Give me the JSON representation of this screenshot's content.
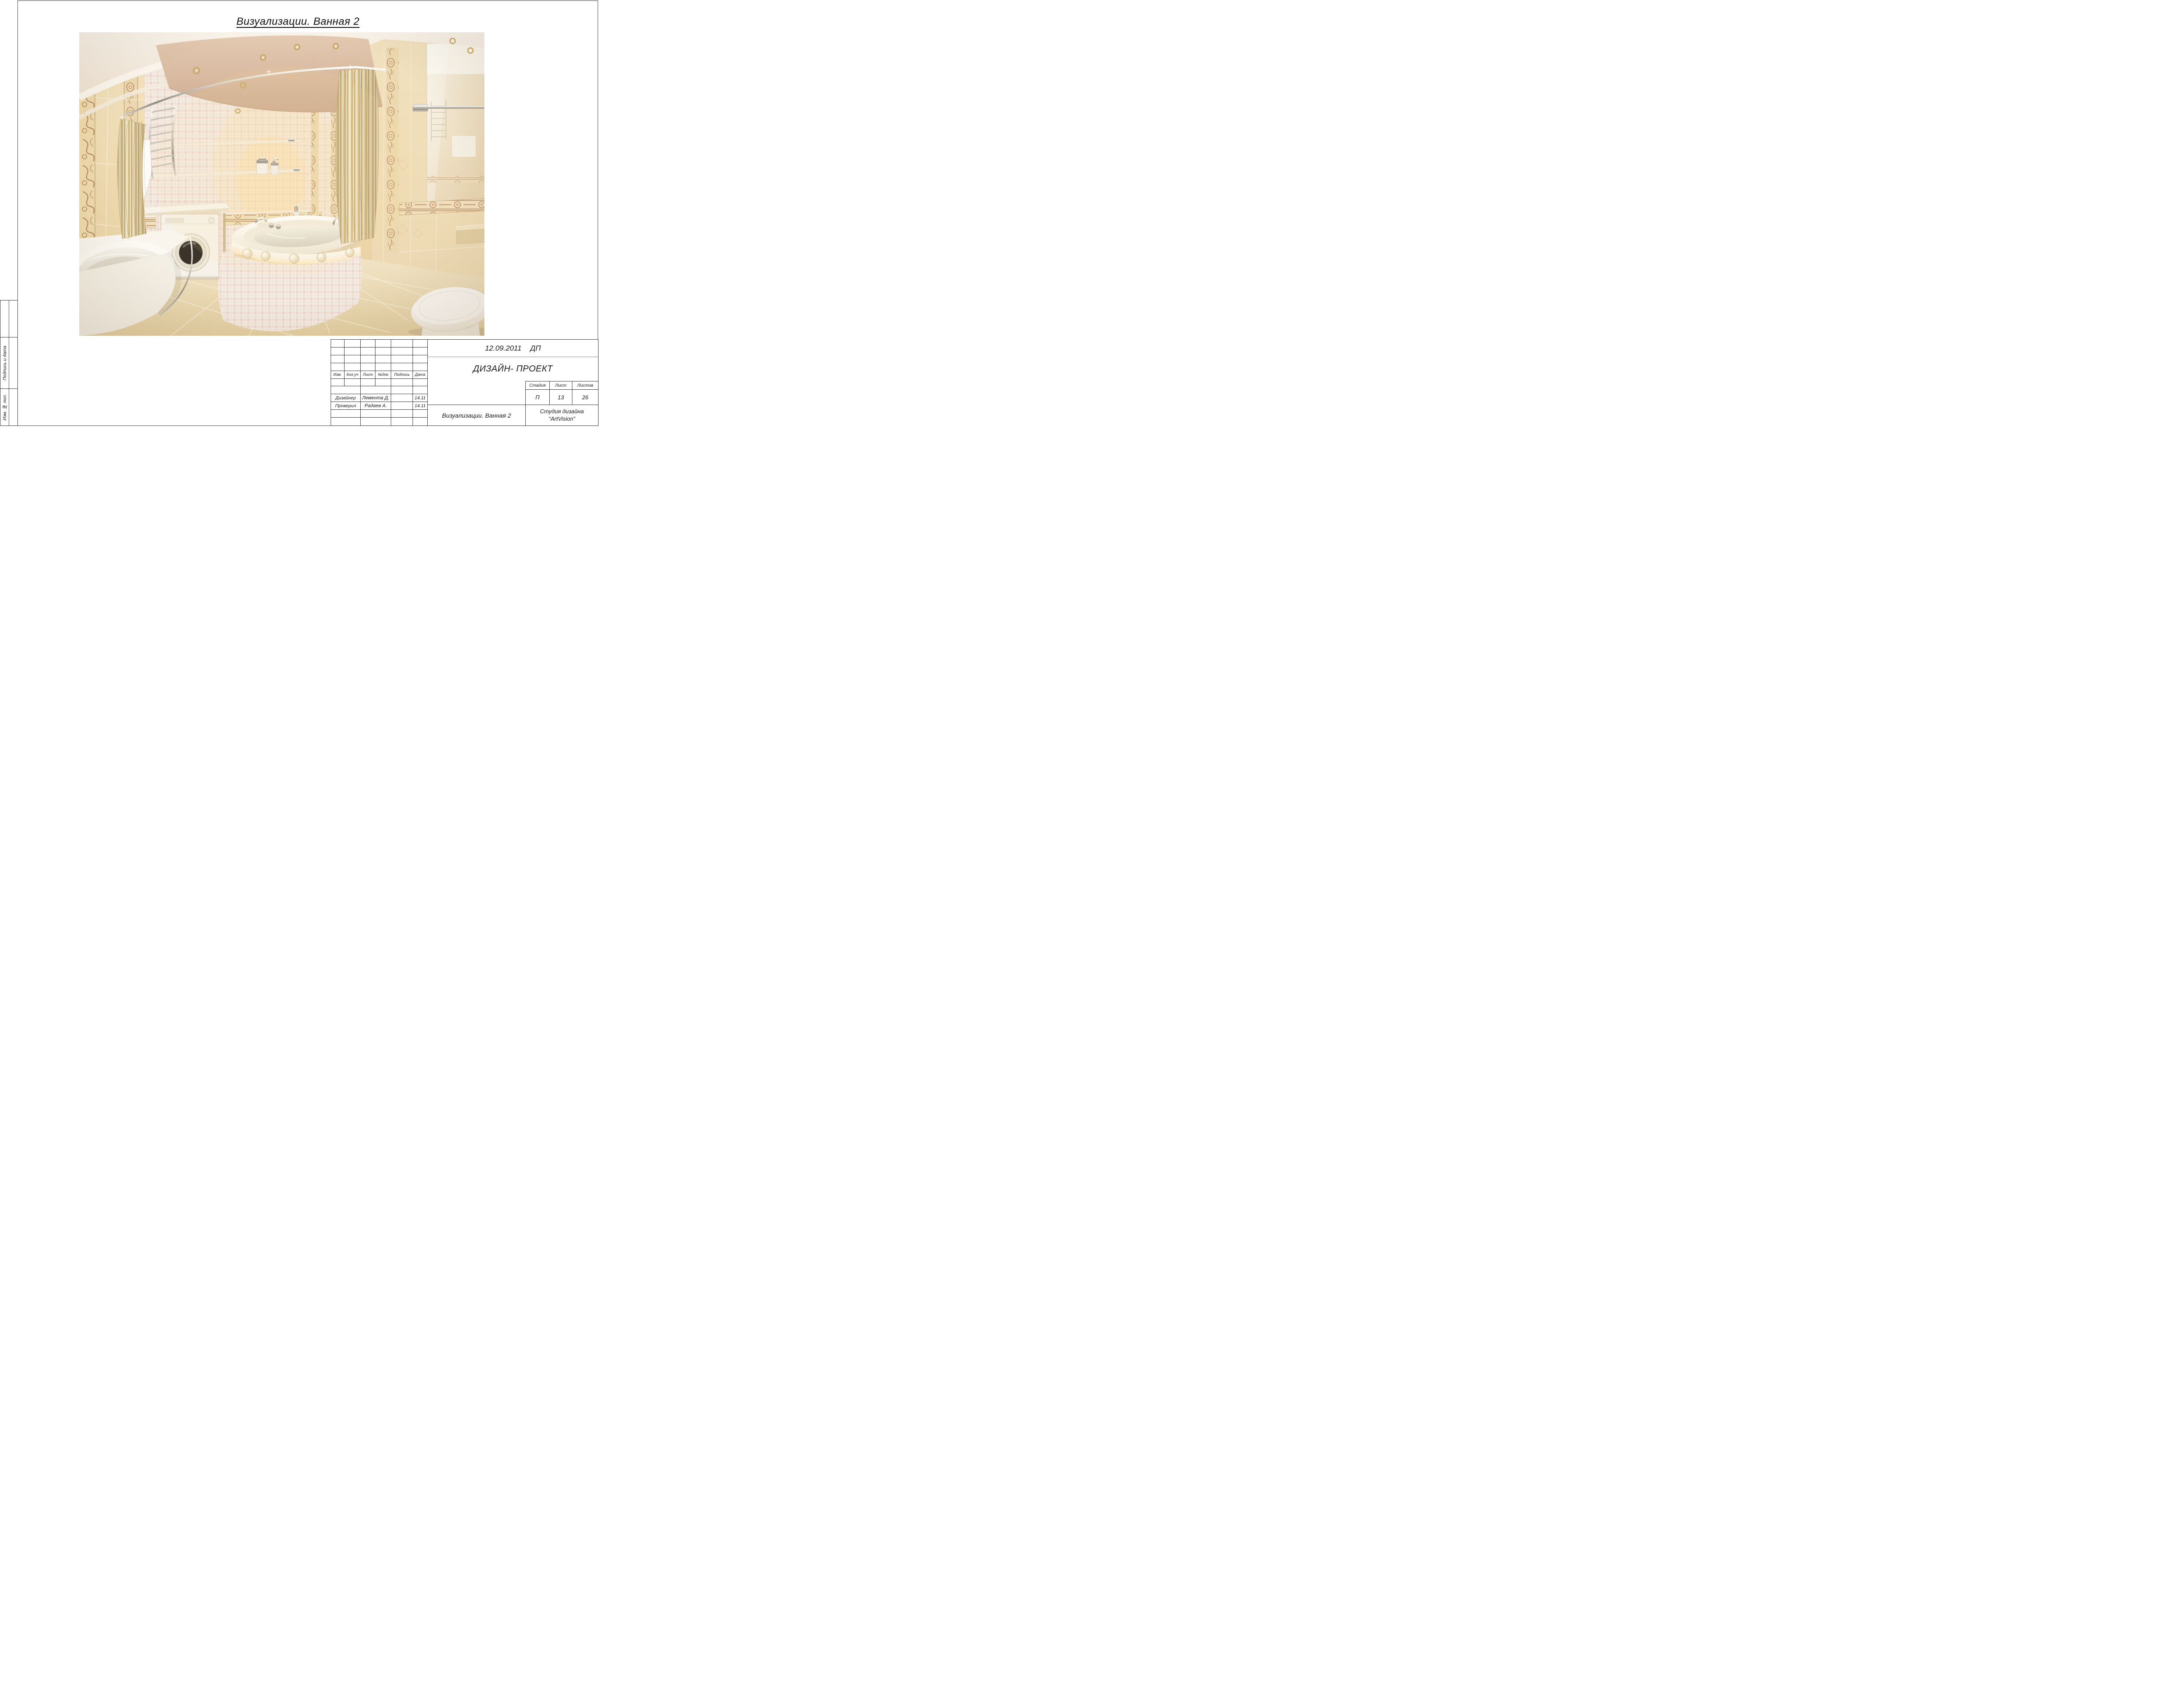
{
  "page": {
    "title": "Визуализации. Ванная 2"
  },
  "margin_tables": {
    "signature_date_label": "Подпись и дата",
    "change_number_label": "Изм. № пол."
  },
  "title_block": {
    "columns": [
      "Изм.",
      "Кол.уч",
      "Лист",
      "№док",
      "Подпись",
      "Дата"
    ],
    "rows": [
      {
        "role": "Дизайнер",
        "name": "Лемента Д.",
        "signature": "",
        "date": "14.11"
      },
      {
        "role": "Проверил",
        "name": "Радаев А.",
        "signature": "",
        "date": "14.11"
      }
    ],
    "doc_date": "12.09.2011",
    "doc_code": "ДП",
    "project_type": "ДИЗАЙН- ПРОЕКТ",
    "stage": {
      "headers": [
        "Стадия",
        "Лист",
        "Листов"
      ],
      "stage_value": "П",
      "sheet_value": "13",
      "sheets_total_value": "26"
    },
    "sheet_caption": "Визуализации. Ванная 2",
    "organization_line1": "Студия дизайна",
    "organization_line2": "“ArtVision”"
  },
  "illustration": {
    "alt": "3D render of a classic beige bathroom: corner jacuzzi bath with mosaic apron and glass decor balls, curved chrome rod with striped gold curtains, tiled niche with glass shelves and dispensers, shower mixer, built-in washing machine under a white counter, curved white vanity with basin, chrome towel warmer, white towels, large mirror with chrome rail and a toilet",
    "palette": {
      "wall_tile": "#edd9b0",
      "wall_tile_dark": "#e3cb9e",
      "ornament_brown": "#b08455",
      "ceiling": "#f6f0e6",
      "ceiling_panel": "#d9bda4",
      "curtain_gold": "#d8c28c",
      "curtain_cream": "#f0e5c8",
      "mosaic_pink": "#eedcd2",
      "fixture_white": "#f8f4ec",
      "chrome": "#b9b2a6",
      "floor_tile": "#ecdbb4",
      "washer_door": "#3e352b",
      "glow_warm": "#ffe2a0"
    }
  }
}
